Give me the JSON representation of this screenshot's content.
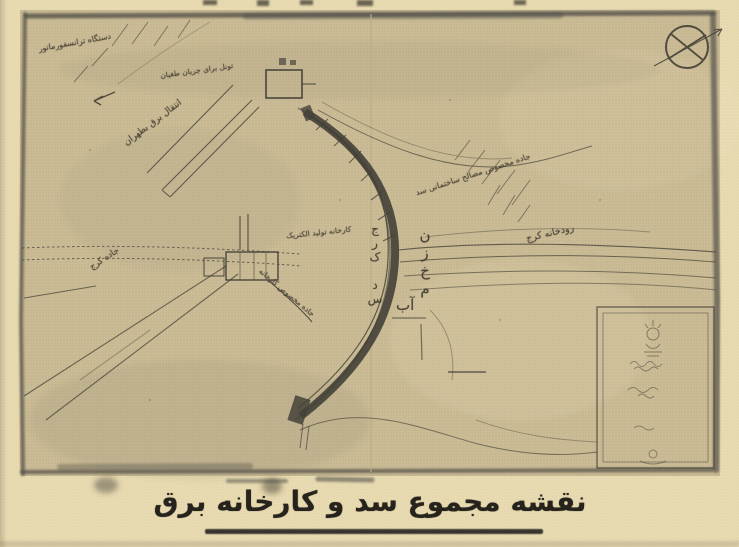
{
  "caption": "نقشه مجموع سد و کارخانه برق",
  "labels": {
    "transformer_station": "دستگاه ترانسفورماتور",
    "power_line_to_tehran": "انتقال برق بطهران",
    "flood_channel": "تونل برای جریان طغیان",
    "construction_road": "جاده مخصوص مصالح ساختمانی سد",
    "karaj_river": "رودخانه کرج",
    "dam_vertical": "سد کرج",
    "reservoir_vertical": "مخزن",
    "reservoir_water": "آب",
    "power_plant": "کارخانه تولید الکتریک",
    "plant_road": "جاده مخصوص کارخانه",
    "karaj_road": "جاده کرج"
  },
  "colors": {
    "map_paper": "#cbbc95",
    "margin_paper": "#e9dbb1",
    "ink": "#44413a",
    "caption_ink": "#26231d"
  }
}
